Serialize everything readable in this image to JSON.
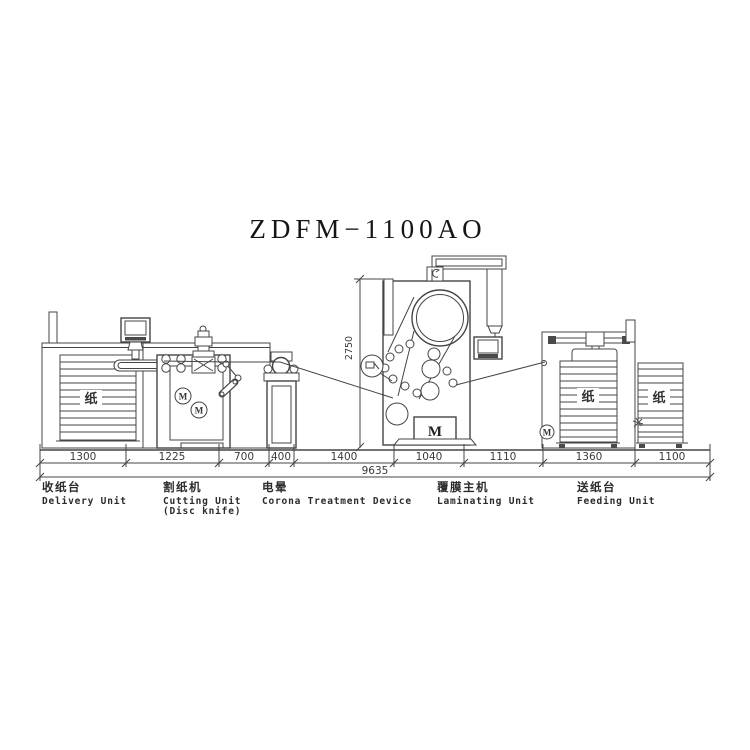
{
  "title": "ZDFM−1100AO",
  "dims": {
    "segments": [
      "1300",
      "1225",
      "700",
      "400",
      "1400",
      "1040",
      "1110",
      "1360",
      "1100"
    ],
    "total": "9635",
    "height": "2750"
  },
  "units": [
    {
      "cn": "收纸台",
      "en": "Delivery Unit",
      "en2": ""
    },
    {
      "cn": "割纸机",
      "en": "Cutting Unit",
      "en2": "(Disc knife)"
    },
    {
      "cn": "电晕",
      "en": "Corona Treatment Device",
      "en2": ""
    },
    {
      "cn": "覆膜主机",
      "en": "Laminating Unit",
      "en2": ""
    },
    {
      "cn": "送纸台",
      "en": "Feeding Unit",
      "en2": ""
    }
  ],
  "glyphs": {
    "paper": "纸",
    "motor": "M"
  },
  "colors": {
    "line": "#454545",
    "text": "#2b2b2b",
    "background": "#ffffff"
  }
}
